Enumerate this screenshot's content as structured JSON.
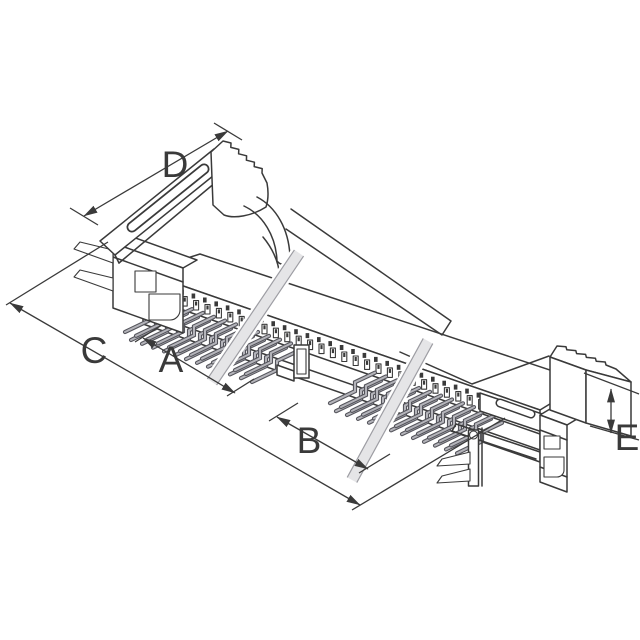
{
  "page": {
    "background": "#ffffff"
  },
  "drawing": {
    "kind": "isometric technical line drawing",
    "subject": "Board-edge connector socket with ejector latches, dual-row right-angle through-hole pins, polarization key and break lines",
    "dimensions": [
      {
        "id": "A",
        "label": "A"
      },
      {
        "id": "B",
        "label": "B"
      },
      {
        "id": "C",
        "label": "C"
      },
      {
        "id": "D",
        "label": "D"
      },
      {
        "id": "E",
        "label": "E"
      }
    ],
    "colors": {
      "line": "#3a3a3a",
      "pin_fill": "#b4b4ba",
      "pin_edge": "#55555c",
      "break_fill": "#e5e5e7",
      "break_edge": "#9d9da3",
      "background": "#ffffff"
    }
  }
}
